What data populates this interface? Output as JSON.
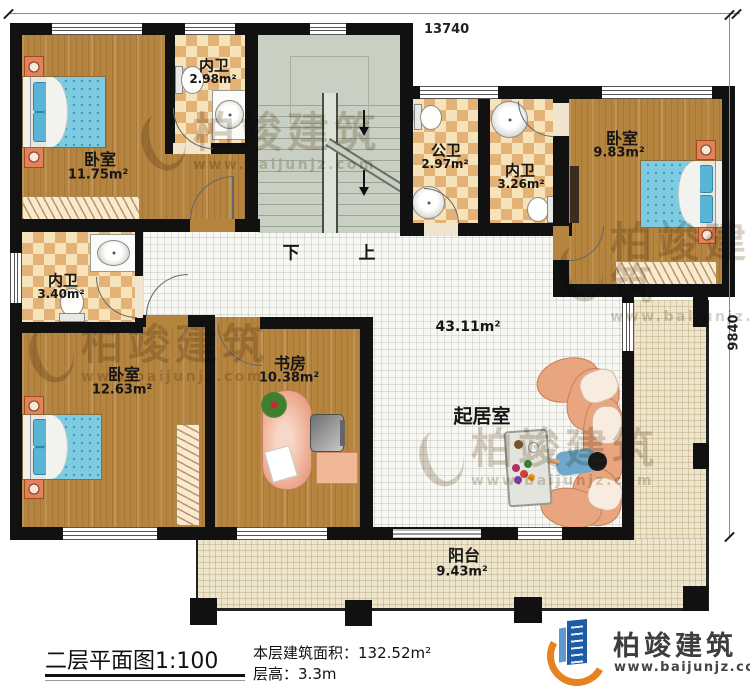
{
  "dimensions": {
    "width": "13740",
    "height": "9840"
  },
  "rooms": {
    "bedroom1": {
      "label": "卧室",
      "area": "11.75m²"
    },
    "bath1": {
      "label": "内卫",
      "area": "2.98m²"
    },
    "public_bath": {
      "label": "公卫",
      "area": "2.97m²"
    },
    "bath2": {
      "label": "内卫",
      "area": "3.26m²"
    },
    "bedroom2": {
      "label": "卧室",
      "area": "9.83m²"
    },
    "bath3": {
      "label": "内卫",
      "area": "3.40m²"
    },
    "bedroom3": {
      "label": "卧室",
      "area": "12.63m²"
    },
    "study": {
      "label": "书房",
      "area": "10.38m²"
    },
    "hall": {
      "area": "43.11m²"
    },
    "living": {
      "label": "起居室"
    },
    "balcony": {
      "label": "阳台",
      "area": "9.43m²"
    }
  },
  "stairs": {
    "down": "下",
    "up": "上"
  },
  "footer": {
    "title": "二层平面图",
    "scale": "1:100",
    "area_label": "本层建筑面积：",
    "area_value": "132.52m²",
    "floor_height_label": "层高：",
    "floor_height_value": "3.3m"
  },
  "brand": {
    "name": "柏竣建筑",
    "website": "www.baijunjz.com"
  },
  "watermark": {
    "name": "柏竣建筑",
    "website": "www.baijunjz.com"
  },
  "colors": {
    "wall": "#111111",
    "wood": "#b5843f",
    "tile_light": "#f6e3ba",
    "tile_dark": "#e2b277",
    "stairs": "#c9d0c3",
    "balcony": "#ede5cd",
    "accent_blue": "#1e5ca6",
    "accent_orange": "#e8821e"
  }
}
